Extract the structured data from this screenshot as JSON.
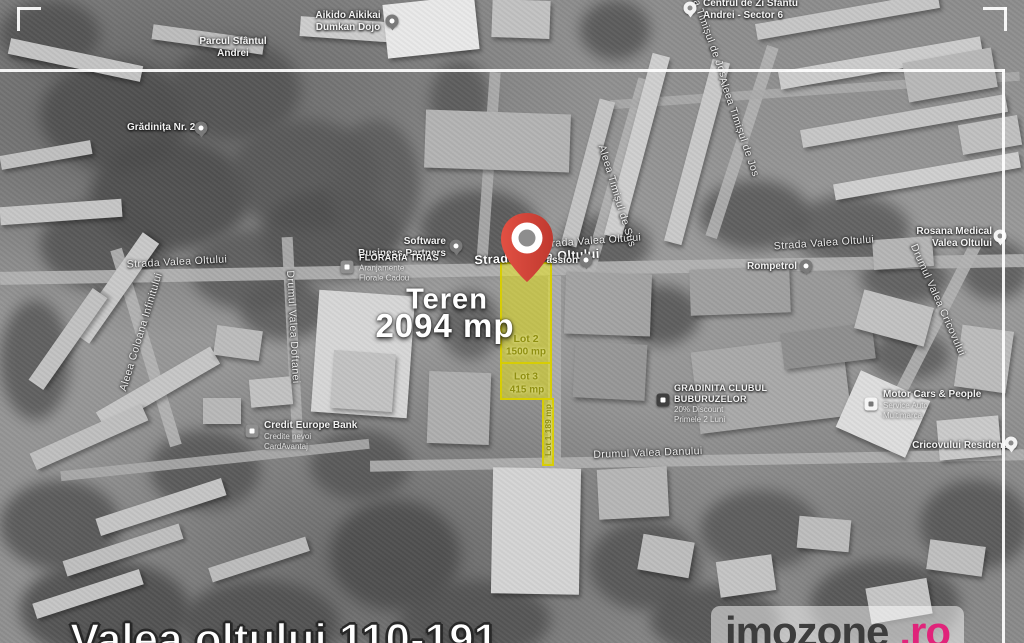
{
  "canvas": {
    "width": 1024,
    "height": 643
  },
  "headline": {
    "teren_label": "Teren",
    "teren_area": "2094 mp",
    "address": "Valea oltului 110-191"
  },
  "lots": {
    "fill_color": "#f4ef00",
    "border_color": "#d8ce00",
    "lot2_name": "Lot 2",
    "lot2_area": "1500 mp",
    "lot3_name": "Lot 3",
    "lot3_area": "415 mp",
    "lot1_text": "Lot 1 189 mp"
  },
  "pin": {
    "color": "#da4336"
  },
  "watermark": {
    "brand": "imozone",
    "tld": ".ro",
    "brand_color": "#3d3d3d",
    "tld_color": "#e0247a"
  },
  "streets": [
    {
      "label": "Strada Valea Oltului"
    },
    {
      "label": "Strada Valea Oltului"
    },
    {
      "label": "Strada Valea Oltului"
    },
    {
      "label": "Strada Valea Oltului"
    },
    {
      "label": "Aleea Timișul de Sus"
    },
    {
      "label": "Aleea Timișul de Jos"
    },
    {
      "label": "Aleea Timișul de Jos"
    },
    {
      "label": "Aleea Coloana Infinitului"
    },
    {
      "label": "Drumul Valea Doftanei"
    },
    {
      "label": "Drumul Valea Cricovului"
    },
    {
      "label": "Drumul Valea Danului"
    }
  ],
  "pois": [
    {
      "line1": "Aikido Aikikai",
      "line2": "Dumkan Dojo",
      "icon": "martial-arts-pin"
    },
    {
      "line1": "Centrul de Zi Sfantu",
      "line2": "Andrei - Sector 6",
      "icon": "community-center-pin"
    },
    {
      "line1": "Parcul Sfântul",
      "line2": "Andrei",
      "icon": "none"
    },
    {
      "line1": "Grădinița Nr. 208",
      "icon": "school-pin"
    },
    {
      "line1": "Software",
      "line2": "Business Partners",
      "icon": "office-pin"
    },
    {
      "line1": "FLORARIA TRIAS",
      "line2": "Aranjamente",
      "line3": "Florale Cadou",
      "icon": "florist-square"
    },
    {
      "line1": "Passion",
      "icon": "restaurant-pin"
    },
    {
      "line1": "Rompetrol",
      "icon": "gas-station-pin"
    },
    {
      "line1": "Rosana Medical",
      "line2": "Valea Oltului",
      "icon": "medical-pin"
    },
    {
      "line1": "GRADINITA CLUBUL",
      "line2": "BUBURUZELOR",
      "line3": "20% Discount",
      "line4": "Primele 2 Luni",
      "icon": "kindergarten-square"
    },
    {
      "line1": "Motor Cars & People",
      "line2": "Service Auto",
      "line3": "Multimarca",
      "icon": "car-service-square"
    },
    {
      "line1": "Credit Europe Bank",
      "line2": "Credite nevoi",
      "line3": "CardAvantaj",
      "icon": "bank-square"
    },
    {
      "line1": "Cricovului Residence",
      "icon": "residence-pin"
    }
  ]
}
